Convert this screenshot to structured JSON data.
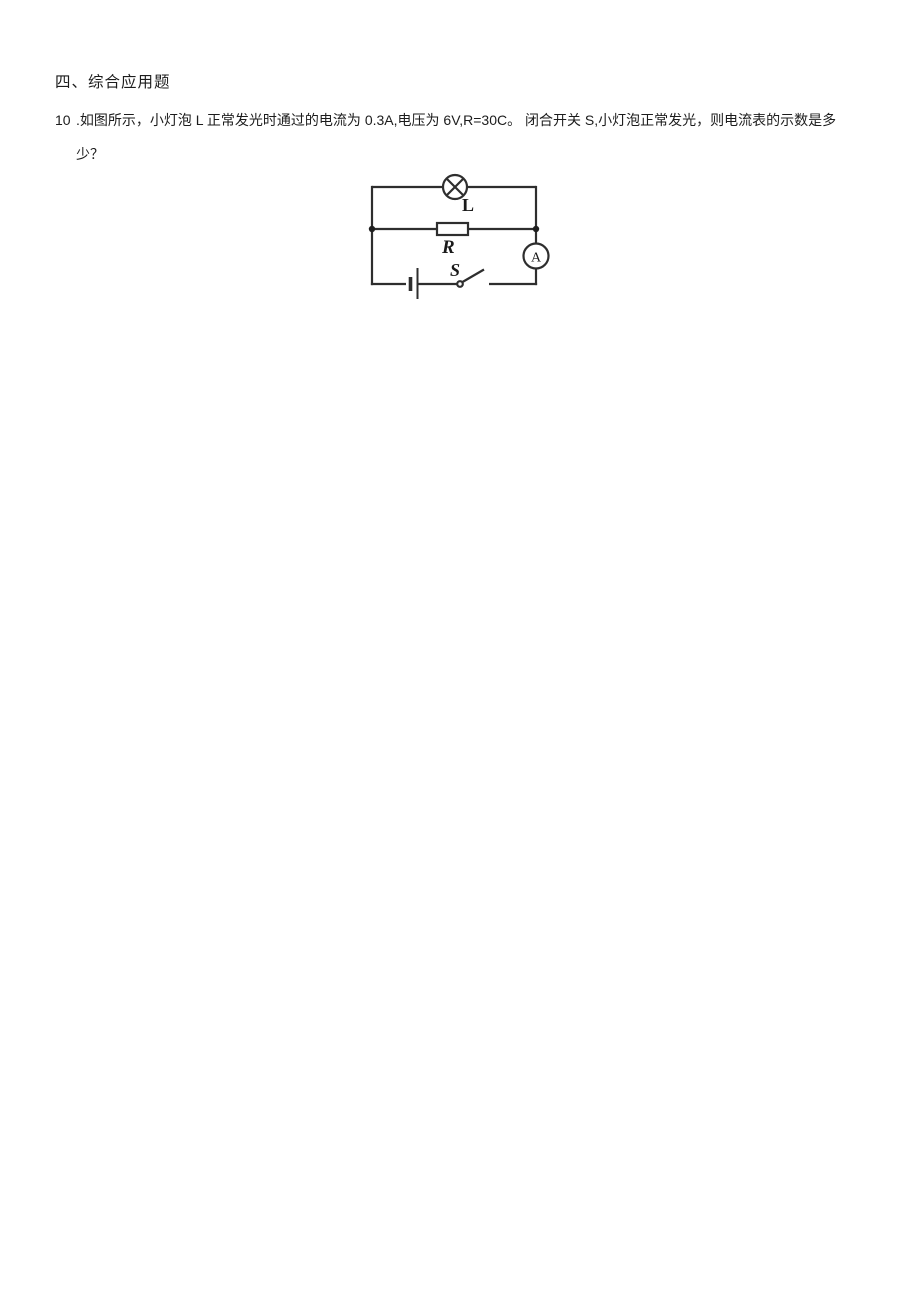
{
  "page": {
    "background_color": "#ffffff",
    "text_color": "#1c1c1c"
  },
  "section": {
    "heading": "四、综合应用题"
  },
  "question": {
    "number": "10",
    "text_line1": ".如图所示，小灯泡 L 正常发光时通过的电流为 0.3A,电压为 6V,R=30C。 闭合开关 S,小灯泡正常发光，则电流表的示数是多",
    "text_line2": "少？"
  },
  "circuit": {
    "stroke_color": "#2e2e2e",
    "labels": {
      "lamp": "L",
      "resistor": "R",
      "switch": "S",
      "ammeter": "A"
    },
    "components": [
      "lamp",
      "resistor",
      "ammeter",
      "battery-cell",
      "open-switch"
    ]
  }
}
